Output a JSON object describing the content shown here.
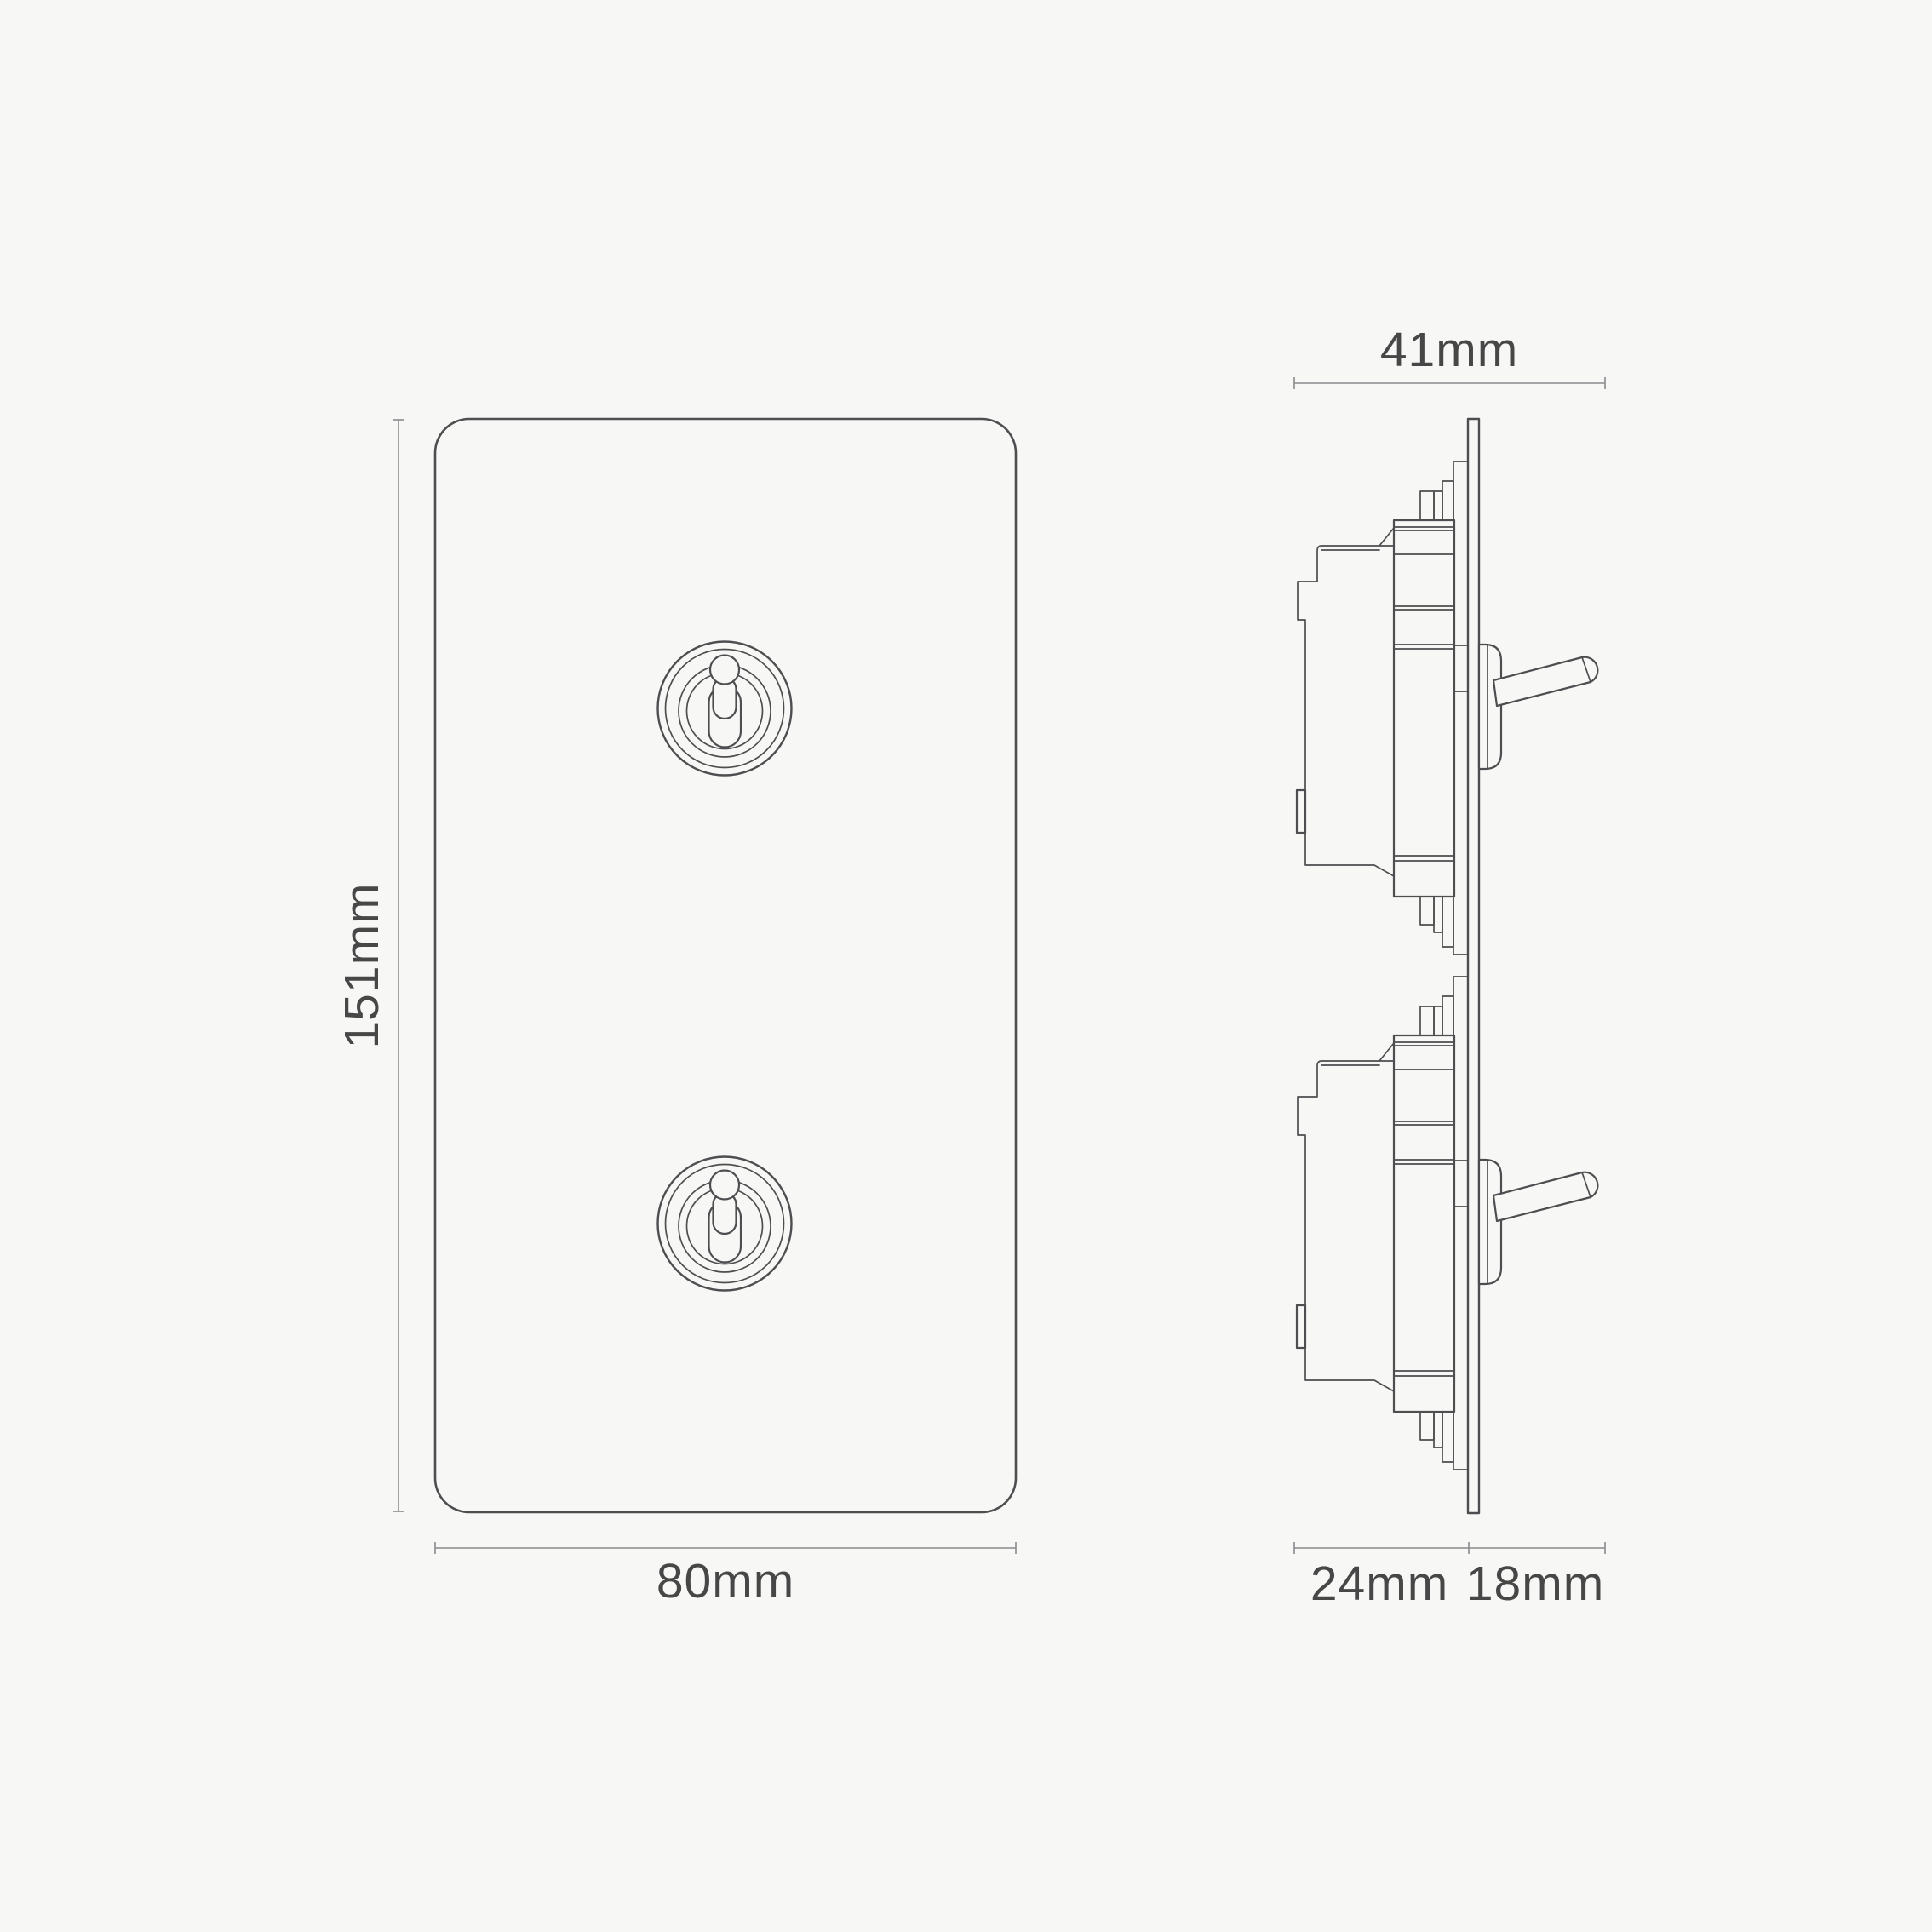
{
  "canvas": {
    "background": "#f7f7f6"
  },
  "colors": {
    "outline": "#4e4e50",
    "dimension_line": "#8a8a8e",
    "label_text": "#474747"
  },
  "front_view": {
    "height_label": "151mm",
    "width_label": "80mm"
  },
  "side_view": {
    "width_label": "41mm",
    "depth_label": "24mm",
    "protrusion_label": "18mm"
  }
}
